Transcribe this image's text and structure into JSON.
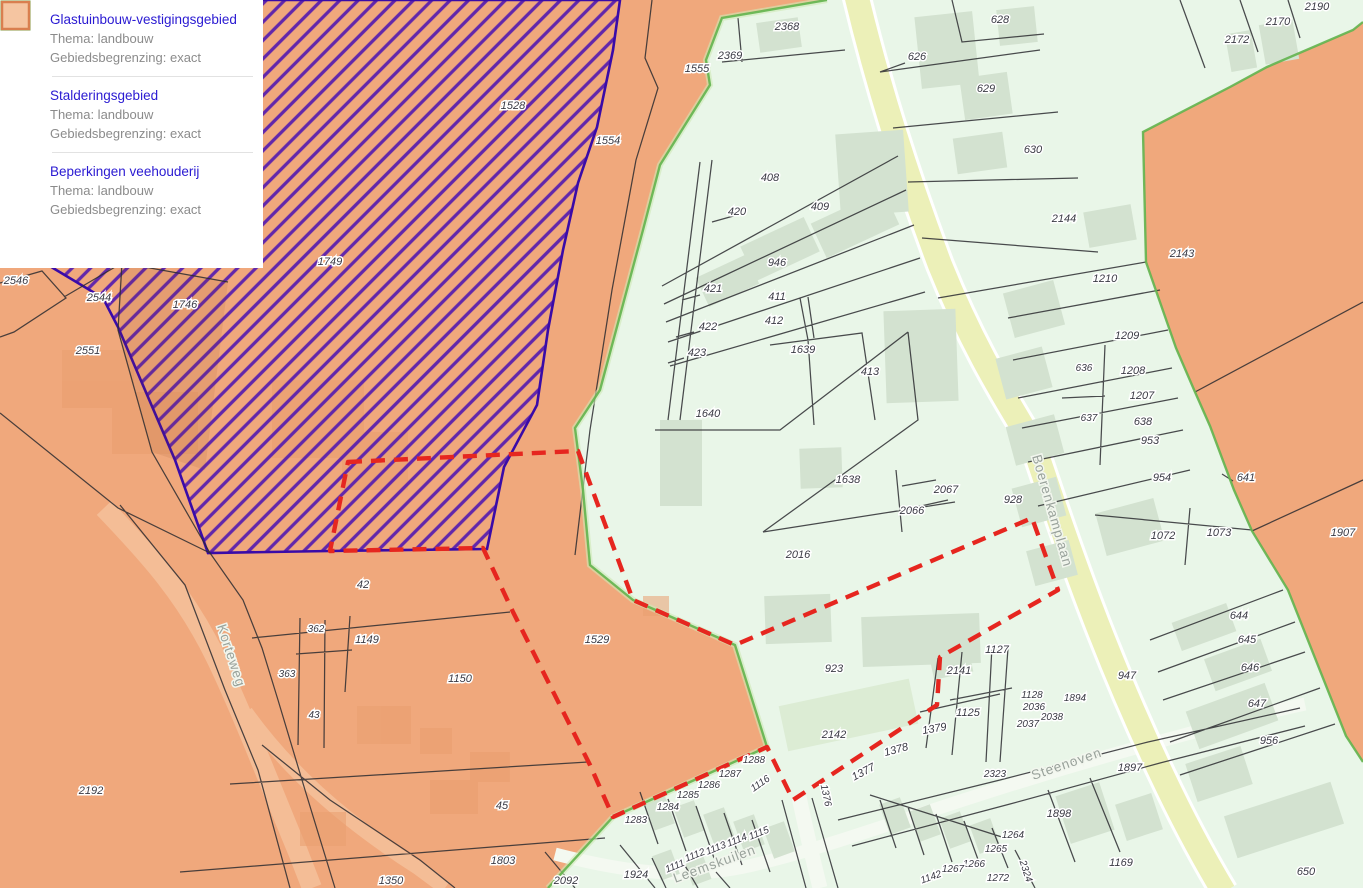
{
  "legend": {
    "items": [
      {
        "title": "Glastuinbouw-vestigingsgebied",
        "thema": "Thema: landbouw",
        "grens": "Gebiedsbegrenzing: exact",
        "swatch": "purple-hatch"
      },
      {
        "title": "Stalderingsgebied",
        "thema": "Thema: landbouw",
        "grens": "Gebiedsbegrenzing: exact",
        "swatch": "green-outline"
      },
      {
        "title": "Beperkingen veehouderij",
        "thema": "Thema: landbouw",
        "grens": "Gebiedsbegrenzing: exact",
        "swatch": "salmon-fill"
      }
    ]
  },
  "colors": {
    "hatch_purple": "#4e15b2",
    "hatch_border": "#3a0ba8",
    "salmon": "#f0a87c",
    "green_area": "#e9f6e8",
    "green_border": "#62b44e",
    "red_dash": "#e6261f",
    "road_yellow": "#ecf0b8",
    "label": "#3a3a44",
    "street": "#99a29b",
    "title_blue": "#2a1ad2"
  },
  "streets": [
    {
      "name": "Korteweg",
      "x": 227,
      "y": 657,
      "r": 72
    },
    {
      "name": "Boerenkamplaan",
      "x": 1048,
      "y": 512,
      "r": 74
    },
    {
      "name": "Leemskuilen",
      "x": 716,
      "y": 868,
      "r": -20
    },
    {
      "name": "Steenoven",
      "x": 1068,
      "y": 768,
      "r": -19
    }
  ],
  "parcels": [
    {
      "t": "2546",
      "x": 16,
      "y": 284
    },
    {
      "t": "2544",
      "x": 99,
      "y": 301
    },
    {
      "t": "1746",
      "x": 185,
      "y": 308
    },
    {
      "t": "2551",
      "x": 88,
      "y": 354
    },
    {
      "t": "1749",
      "x": 330,
      "y": 265
    },
    {
      "t": "1528",
      "x": 513,
      "y": 109
    },
    {
      "t": "1554",
      "x": 608,
      "y": 144
    },
    {
      "t": "1555",
      "x": 697,
      "y": 72
    },
    {
      "t": "2368",
      "x": 787,
      "y": 30
    },
    {
      "t": "2369",
      "x": 730,
      "y": 59
    },
    {
      "t": "626",
      "x": 917,
      "y": 60
    },
    {
      "t": "628",
      "x": 1000,
      "y": 23
    },
    {
      "t": "629",
      "x": 986,
      "y": 92
    },
    {
      "t": "630",
      "x": 1033,
      "y": 153
    },
    {
      "t": "2144",
      "x": 1064,
      "y": 222
    },
    {
      "t": "2190",
      "x": 1317,
      "y": 10
    },
    {
      "t": "2170",
      "x": 1278,
      "y": 25
    },
    {
      "t": "2172",
      "x": 1237,
      "y": 43
    },
    {
      "t": "2143",
      "x": 1182,
      "y": 257
    },
    {
      "t": "408",
      "x": 770,
      "y": 181
    },
    {
      "t": "420",
      "x": 737,
      "y": 215
    },
    {
      "t": "409",
      "x": 820,
      "y": 210
    },
    {
      "t": "946",
      "x": 777,
      "y": 266
    },
    {
      "t": "421",
      "x": 713,
      "y": 292
    },
    {
      "t": "411",
      "x": 777,
      "y": 300
    },
    {
      "t": "422",
      "x": 708,
      "y": 330
    },
    {
      "t": "412",
      "x": 774,
      "y": 324
    },
    {
      "t": "423",
      "x": 697,
      "y": 356
    },
    {
      "t": "1639",
      "x": 803,
      "y": 353
    },
    {
      "t": "413",
      "x": 870,
      "y": 375
    },
    {
      "t": "1640",
      "x": 708,
      "y": 417
    },
    {
      "t": "1638",
      "x": 848,
      "y": 483
    },
    {
      "t": "2067",
      "x": 946,
      "y": 493
    },
    {
      "t": "2066",
      "x": 912,
      "y": 514
    },
    {
      "t": "928",
      "x": 1013,
      "y": 503
    },
    {
      "t": "2016",
      "x": 798,
      "y": 558
    },
    {
      "t": "1210",
      "x": 1105,
      "y": 282
    },
    {
      "t": "1209",
      "x": 1127,
      "y": 339
    },
    {
      "t": "636",
      "x": 1084,
      "y": 371,
      "s": 10
    },
    {
      "t": "1208",
      "x": 1133,
      "y": 374
    },
    {
      "t": "1207",
      "x": 1142,
      "y": 399
    },
    {
      "t": "637",
      "x": 1089,
      "y": 421,
      "s": 10
    },
    {
      "t": "638",
      "x": 1143,
      "y": 425
    },
    {
      "t": "953",
      "x": 1150,
      "y": 444
    },
    {
      "t": "954",
      "x": 1162,
      "y": 481
    },
    {
      "t": "641",
      "x": 1246,
      "y": 481
    },
    {
      "t": "1072",
      "x": 1163,
      "y": 539
    },
    {
      "t": "1073",
      "x": 1219,
      "y": 536
    },
    {
      "t": "1907",
      "x": 1343,
      "y": 536
    },
    {
      "t": "42",
      "x": 363,
      "y": 588
    },
    {
      "t": "362",
      "x": 316,
      "y": 632,
      "s": 10
    },
    {
      "t": "1149",
      "x": 367,
      "y": 643
    },
    {
      "t": "363",
      "x": 287,
      "y": 677,
      "s": 10
    },
    {
      "t": "1150",
      "x": 460,
      "y": 682
    },
    {
      "t": "43",
      "x": 314,
      "y": 718,
      "s": 10
    },
    {
      "t": "1529",
      "x": 597,
      "y": 643
    },
    {
      "t": "2192",
      "x": 91,
      "y": 794
    },
    {
      "t": "45",
      "x": 502,
      "y": 809
    },
    {
      "t": "1803",
      "x": 503,
      "y": 864
    },
    {
      "t": "2092",
      "x": 566,
      "y": 884
    },
    {
      "t": "1350",
      "x": 391,
      "y": 884
    },
    {
      "t": "923",
      "x": 834,
      "y": 672
    },
    {
      "t": "1127",
      "x": 997,
      "y": 653
    },
    {
      "t": "2141",
      "x": 959,
      "y": 674
    },
    {
      "t": "1125",
      "x": 968,
      "y": 716
    },
    {
      "t": "1379",
      "x": 935,
      "y": 732,
      "r": -10
    },
    {
      "t": "1378",
      "x": 897,
      "y": 753,
      "r": -15
    },
    {
      "t": "1377",
      "x": 865,
      "y": 775,
      "r": -28
    },
    {
      "t": "1376",
      "x": 823,
      "y": 796,
      "r": 78,
      "s": 10
    },
    {
      "t": "2142",
      "x": 834,
      "y": 738
    },
    {
      "t": "1288",
      "x": 754,
      "y": 763,
      "s": 10
    },
    {
      "t": "1287",
      "x": 730,
      "y": 777,
      "s": 10
    },
    {
      "t": "1286",
      "x": 709,
      "y": 788,
      "s": 10
    },
    {
      "t": "1285",
      "x": 688,
      "y": 798,
      "s": 10
    },
    {
      "t": "1284",
      "x": 668,
      "y": 810,
      "s": 10
    },
    {
      "t": "1283",
      "x": 636,
      "y": 823,
      "s": 10
    },
    {
      "t": "1116",
      "x": 762,
      "y": 786,
      "r": -35,
      "s": 10
    },
    {
      "t": "1115",
      "x": 760,
      "y": 836,
      "r": -22,
      "s": 10
    },
    {
      "t": "1114",
      "x": 738,
      "y": 843,
      "r": -22,
      "s": 10
    },
    {
      "t": "1113",
      "x": 717,
      "y": 851,
      "r": -22,
      "s": 10
    },
    {
      "t": "1112",
      "x": 696,
      "y": 858,
      "r": -22,
      "s": 10
    },
    {
      "t": "1111",
      "x": 676,
      "y": 869,
      "r": -22,
      "s": 10
    },
    {
      "t": "1924",
      "x": 636,
      "y": 878
    },
    {
      "t": "947",
      "x": 1127,
      "y": 679
    },
    {
      "t": "644",
      "x": 1239,
      "y": 619
    },
    {
      "t": "645",
      "x": 1247,
      "y": 643
    },
    {
      "t": "646",
      "x": 1250,
      "y": 671
    },
    {
      "t": "647",
      "x": 1257,
      "y": 707
    },
    {
      "t": "956",
      "x": 1269,
      "y": 744
    },
    {
      "t": "1128",
      "x": 1032,
      "y": 698,
      "s": 10
    },
    {
      "t": "1894",
      "x": 1075,
      "y": 701,
      "s": 10
    },
    {
      "t": "2036",
      "x": 1034,
      "y": 710,
      "s": 10
    },
    {
      "t": "2038",
      "x": 1052,
      "y": 720,
      "s": 10
    },
    {
      "t": "2037",
      "x": 1028,
      "y": 727,
      "s": 10
    },
    {
      "t": "2323",
      "x": 995,
      "y": 777,
      "s": 10
    },
    {
      "t": "1897",
      "x": 1130,
      "y": 771
    },
    {
      "t": "1898",
      "x": 1059,
      "y": 817
    },
    {
      "t": "1264",
      "x": 1013,
      "y": 838,
      "s": 10
    },
    {
      "t": "1265",
      "x": 996,
      "y": 852,
      "s": 10
    },
    {
      "t": "1266",
      "x": 974,
      "y": 867,
      "s": 10
    },
    {
      "t": "1267",
      "x": 953,
      "y": 872,
      "s": 10
    },
    {
      "t": "1142",
      "x": 932,
      "y": 880,
      "r": -20,
      "s": 10
    },
    {
      "t": "1272",
      "x": 998,
      "y": 881,
      "s": 10
    },
    {
      "t": "2324",
      "x": 1023,
      "y": 872,
      "r": 72,
      "s": 10
    },
    {
      "t": "1169",
      "x": 1121,
      "y": 866
    },
    {
      "t": "650",
      "x": 1306,
      "y": 875
    }
  ]
}
